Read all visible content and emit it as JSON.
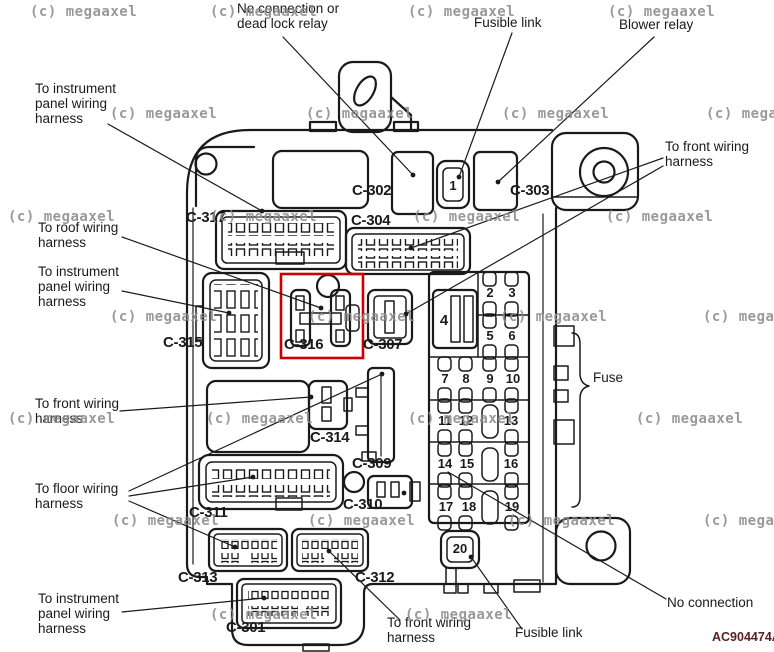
{
  "colors": {
    "line": "#1a1a1a",
    "highlight": "#cc0000",
    "watermark": "#8c8c8c",
    "ref_code": "#5b2120"
  },
  "watermark": {
    "text": "(c) megaaxel"
  },
  "ref_code": "AC904474A",
  "callouts": {
    "dead_lock": {
      "l1": "No connection or",
      "l2": "dead lock relay"
    },
    "fusible_link_top": "Fusible link",
    "blower_relay": "Blower relay",
    "instr_top": {
      "l1": "To instrument",
      "l2": "panel wiring",
      "l3": "harness"
    },
    "roof": {
      "l1": "To roof wiring",
      "l2": "harness"
    },
    "instr_mid": {
      "l1": "To instrument",
      "l2": "panel wiring",
      "l3": "harness"
    },
    "front_right": {
      "l1": "To front wiring",
      "l2": "harness"
    },
    "front_left": {
      "l1": "To front wiring",
      "l2": "harness"
    },
    "floor": {
      "l1": "To floor wiring",
      "l2": "harness"
    },
    "instr_bottom": {
      "l1": "To instrument",
      "l2": "panel wiring",
      "l3": "harness"
    },
    "front_bottom": {
      "l1": "To front wiring",
      "l2": "harness"
    },
    "fusible_link_bottom": "Fusible link",
    "no_connection": "No connection",
    "fuse": "Fuse"
  },
  "connectors": {
    "c301": "C-301",
    "c302": "C-302",
    "c303": "C-303",
    "c304": "C-304",
    "c307": "C-307",
    "c309": "C-309",
    "c310": "C-310",
    "c311": "C-311",
    "c312": "C-312",
    "c313": "C-313",
    "c314": "C-314",
    "c315": "C-315",
    "c316": "C-316",
    "c317": "C-317"
  },
  "fuses": {
    "f1": "1",
    "f2": "2",
    "f3": "3",
    "f4": "4",
    "f5": "5",
    "f6": "6",
    "f7": "7",
    "f8": "8",
    "f9": "9",
    "f10": "10",
    "f11": "11",
    "f12": "12",
    "f13": "13",
    "f14": "14",
    "f15": "15",
    "f16": "16",
    "f17": "17",
    "f18": "18",
    "f19": "19",
    "f20": "20"
  }
}
